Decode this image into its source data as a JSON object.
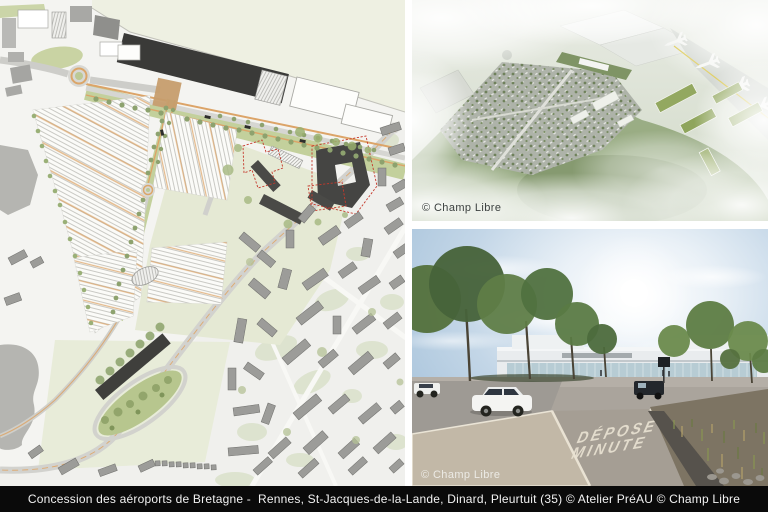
{
  "caption": {
    "text": "Concession des aéroports de Bretagne -  Rennes, St-Jacques-de-la-Lande, Dinard, Pleurtuit (35) © Atelier PréAU © Champ Libre"
  },
  "panels": {
    "aerial_view": {
      "credit": "© Champ Libre"
    },
    "street_view": {
      "credit": "© Champ Libre",
      "road_marking": {
        "line1": "DÉPOSE",
        "line2": "MINUTE"
      }
    }
  },
  "palette": {
    "caption_bar": "#0a0a0a",
    "caption_text": "#f2f2f2",
    "map_background": "#f4f4f1",
    "airfield_beige": "#eef0e2",
    "terminal_dark": "#3a3a38",
    "road_orange": "#dca468",
    "verge_green": "#c3d09c",
    "tree_green": "#8da26e",
    "parcel_green": "#e5e9d4",
    "building_gray": "#9c9c99",
    "red_dashed_outline": "#c5392c",
    "park_green": "#b7c68e",
    "sky_blue": "#9dbcd6",
    "foliage_green": "#54713d"
  }
}
